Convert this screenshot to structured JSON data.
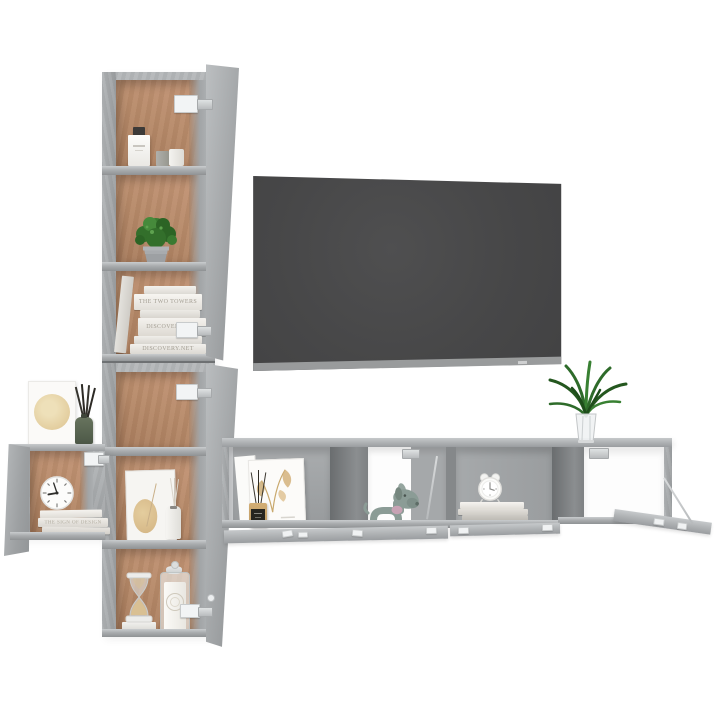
{
  "scene": {
    "background": "#ffffff",
    "subject": "Wall-mounted TV cabinet set in concrete grey with decor items and a flat-screen TV",
    "palette": {
      "concrete_light": "#b7babc",
      "concrete": "#a6a9ab",
      "concrete_shadow": "#8e9193",
      "divider_dark": "#6f7274",
      "wood_interior": "#b78a69",
      "tv_screen": "#4a4a4b",
      "tv_bezel": "#a3a4a5",
      "foliage_green": "#2e6b2a",
      "dog_grey_green": "#8b9c96",
      "collar_pink": "#c7a3b4",
      "diffuser_green": "#5c6852",
      "diffuser_wood": "#c8a36a",
      "sand_beige": "#d9c093",
      "art_beige": "#e2cf9f"
    }
  },
  "decor_texts": {
    "tall_book_spine_1": "THE TWO TOWERS",
    "tall_book_spine_2": "DISCOVERY.NET",
    "tall_book_spine_3": "DISCOVERY.NET",
    "small_book_spine": "THE SIGN OF DESIGN"
  },
  "items": {
    "tall_cabinet_upper": [
      "perfume bottle with dark cap",
      "two candle jars",
      "potted green plant",
      "stack of white books"
    ],
    "tall_cabinet_lower": [
      "framed abstract print",
      "reed diffuser bottle",
      "hourglass with beige sand",
      "glass apothecary candle jar"
    ],
    "small_wall_cabinet": [
      "framed moon print",
      "green reed diffuser",
      "round wall clock",
      "stack of books"
    ],
    "tv_bench": [
      "two framed prints",
      "wooden reed diffuser",
      "grey dog figurine with pink collar",
      "alarm clock on book stack",
      "glass vase with green plant"
    ],
    "tv": "wall-mounted flat screen, switched off"
  }
}
